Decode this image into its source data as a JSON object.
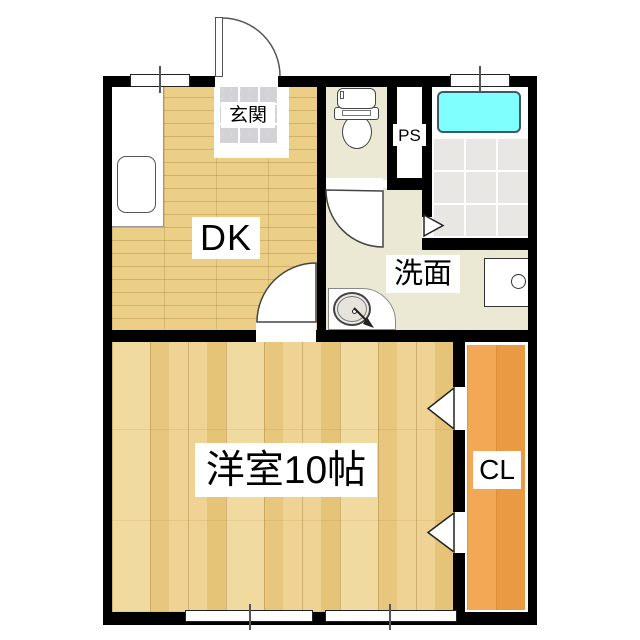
{
  "floorplan": {
    "rooms": {
      "genkan": {
        "label": "玄関"
      },
      "dk": {
        "label": "DK"
      },
      "ps": {
        "label": "PS"
      },
      "senmen": {
        "label": "洗面"
      },
      "west_room": {
        "label": "洋室10帖"
      },
      "closet": {
        "label": "CL"
      }
    },
    "colors": {
      "wall": "#000000",
      "dk_floor": "#eccf87",
      "west_room_floor": "#ecd28f",
      "closet_floor": "#f0a250",
      "wet_area_floor": "#ebe9d4",
      "bath_tile": "#e9e7e4",
      "bathtub": "#80ffff",
      "entry_tile": "#d3d2d7"
    },
    "fixtures": [
      "entrance-door",
      "kitchen-counter",
      "kitchen-sink",
      "toilet",
      "bathtub",
      "bath-folding-door",
      "washbasin",
      "washing-machine-pan",
      "closet-doors",
      "windows"
    ]
  }
}
